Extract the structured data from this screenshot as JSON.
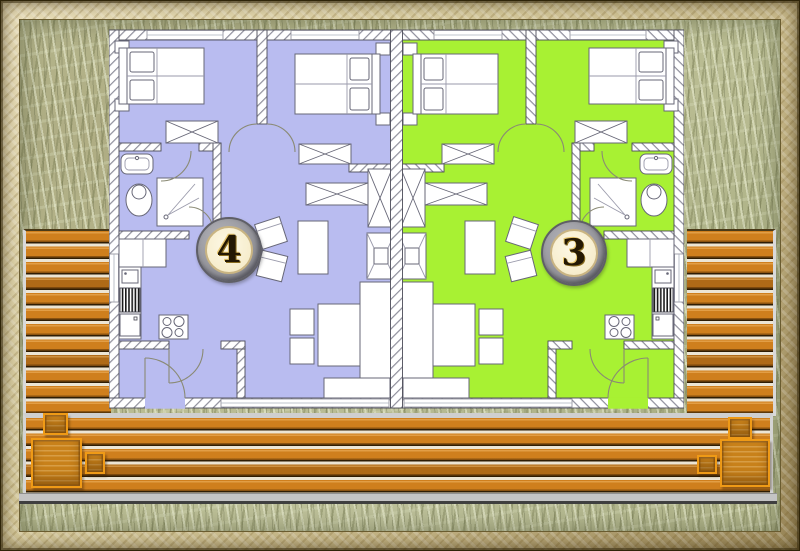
{
  "scene": {
    "description": "Site floor plan of two mirrored holiday apartments with shared wooden deck terrace, grass surroundings and sandy picture frame"
  },
  "badges": {
    "unit_left": {
      "label": "4"
    },
    "unit_right": {
      "label": "3"
    }
  },
  "units": [
    {
      "number": "4",
      "position": "left",
      "floor_color": "#b9bcf0"
    },
    {
      "number": "3",
      "position": "right",
      "floor_color": "#a8f133"
    }
  ],
  "colors": {
    "unit_left_floor": "#b9bcf0",
    "unit_right_floor": "#a8f133",
    "deck_plank": "#cf7f1d",
    "deck_gap": "#ece5d4",
    "deck_edge_gray": "#c4c4c4",
    "wood_furniture": "#c8811a",
    "grass": "#b9bc92",
    "frame": "#d8cc9f",
    "wall_hatch": "#8f8f9c",
    "badge_ring": "#8d8d93",
    "badge_face": "#f6ecca"
  },
  "icons": [
    "double-bed",
    "nightstand",
    "wardrobe-crossed",
    "sideboard-crossed",
    "tv-unit",
    "dining-table",
    "chair",
    "sofa",
    "sofa-cushion",
    "kitchen-counter",
    "kitchen-sink",
    "dishwasher-striped",
    "stove-four-burners",
    "washbasin",
    "toilet",
    "shower",
    "door-arc",
    "window",
    "deck-table",
    "deck-chair"
  ]
}
